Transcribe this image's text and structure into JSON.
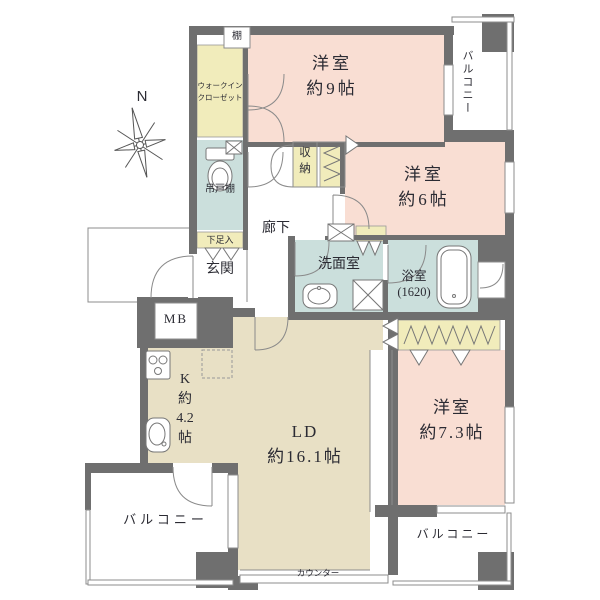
{
  "palette": {
    "wall": "#6F6F6F",
    "bedroom_pink": "#F9DED3",
    "living_beige": "#E8E0C5",
    "wet_area_teal": "#CBDFDC",
    "closet_yellow": "#F1ECBB",
    "line_gray": "#8C8C8C",
    "text": "#2B2B33"
  },
  "compass": {
    "north": "N"
  },
  "rooms": {
    "bedroom9": {
      "label": "洋室\n約9帖"
    },
    "bedroom6": {
      "label": "洋室\n約6帖"
    },
    "bedroom73": {
      "label": "洋室\n約7.3帖"
    },
    "living_dining": {
      "label": "LD\n約16.1帖"
    },
    "kitchen": {
      "label": "K\n約\n4.2\n帖"
    },
    "entrance": {
      "label": "玄関"
    },
    "hallway": {
      "label": "廊下"
    },
    "washroom": {
      "label": "洗面室"
    },
    "bathroom": {
      "label": "浴室\n(1620)"
    }
  },
  "storage": {
    "walk_in_closet": {
      "label": "ウォークイン\nクローゼット"
    },
    "shelf": {
      "label": "棚"
    },
    "hanging_cupboard": {
      "label": "吊戸棚"
    },
    "shoe_cabinet": {
      "label": "下足入"
    },
    "hall_closet": {
      "label": "収納"
    }
  },
  "balconies": {
    "top_right": {
      "label": "バルコニー"
    },
    "bottom_left": {
      "label": "バルコニー"
    },
    "bottom_right": {
      "label": "バルコニー"
    }
  },
  "labels": {
    "meter_box": "MB",
    "counter": "カウンター"
  }
}
